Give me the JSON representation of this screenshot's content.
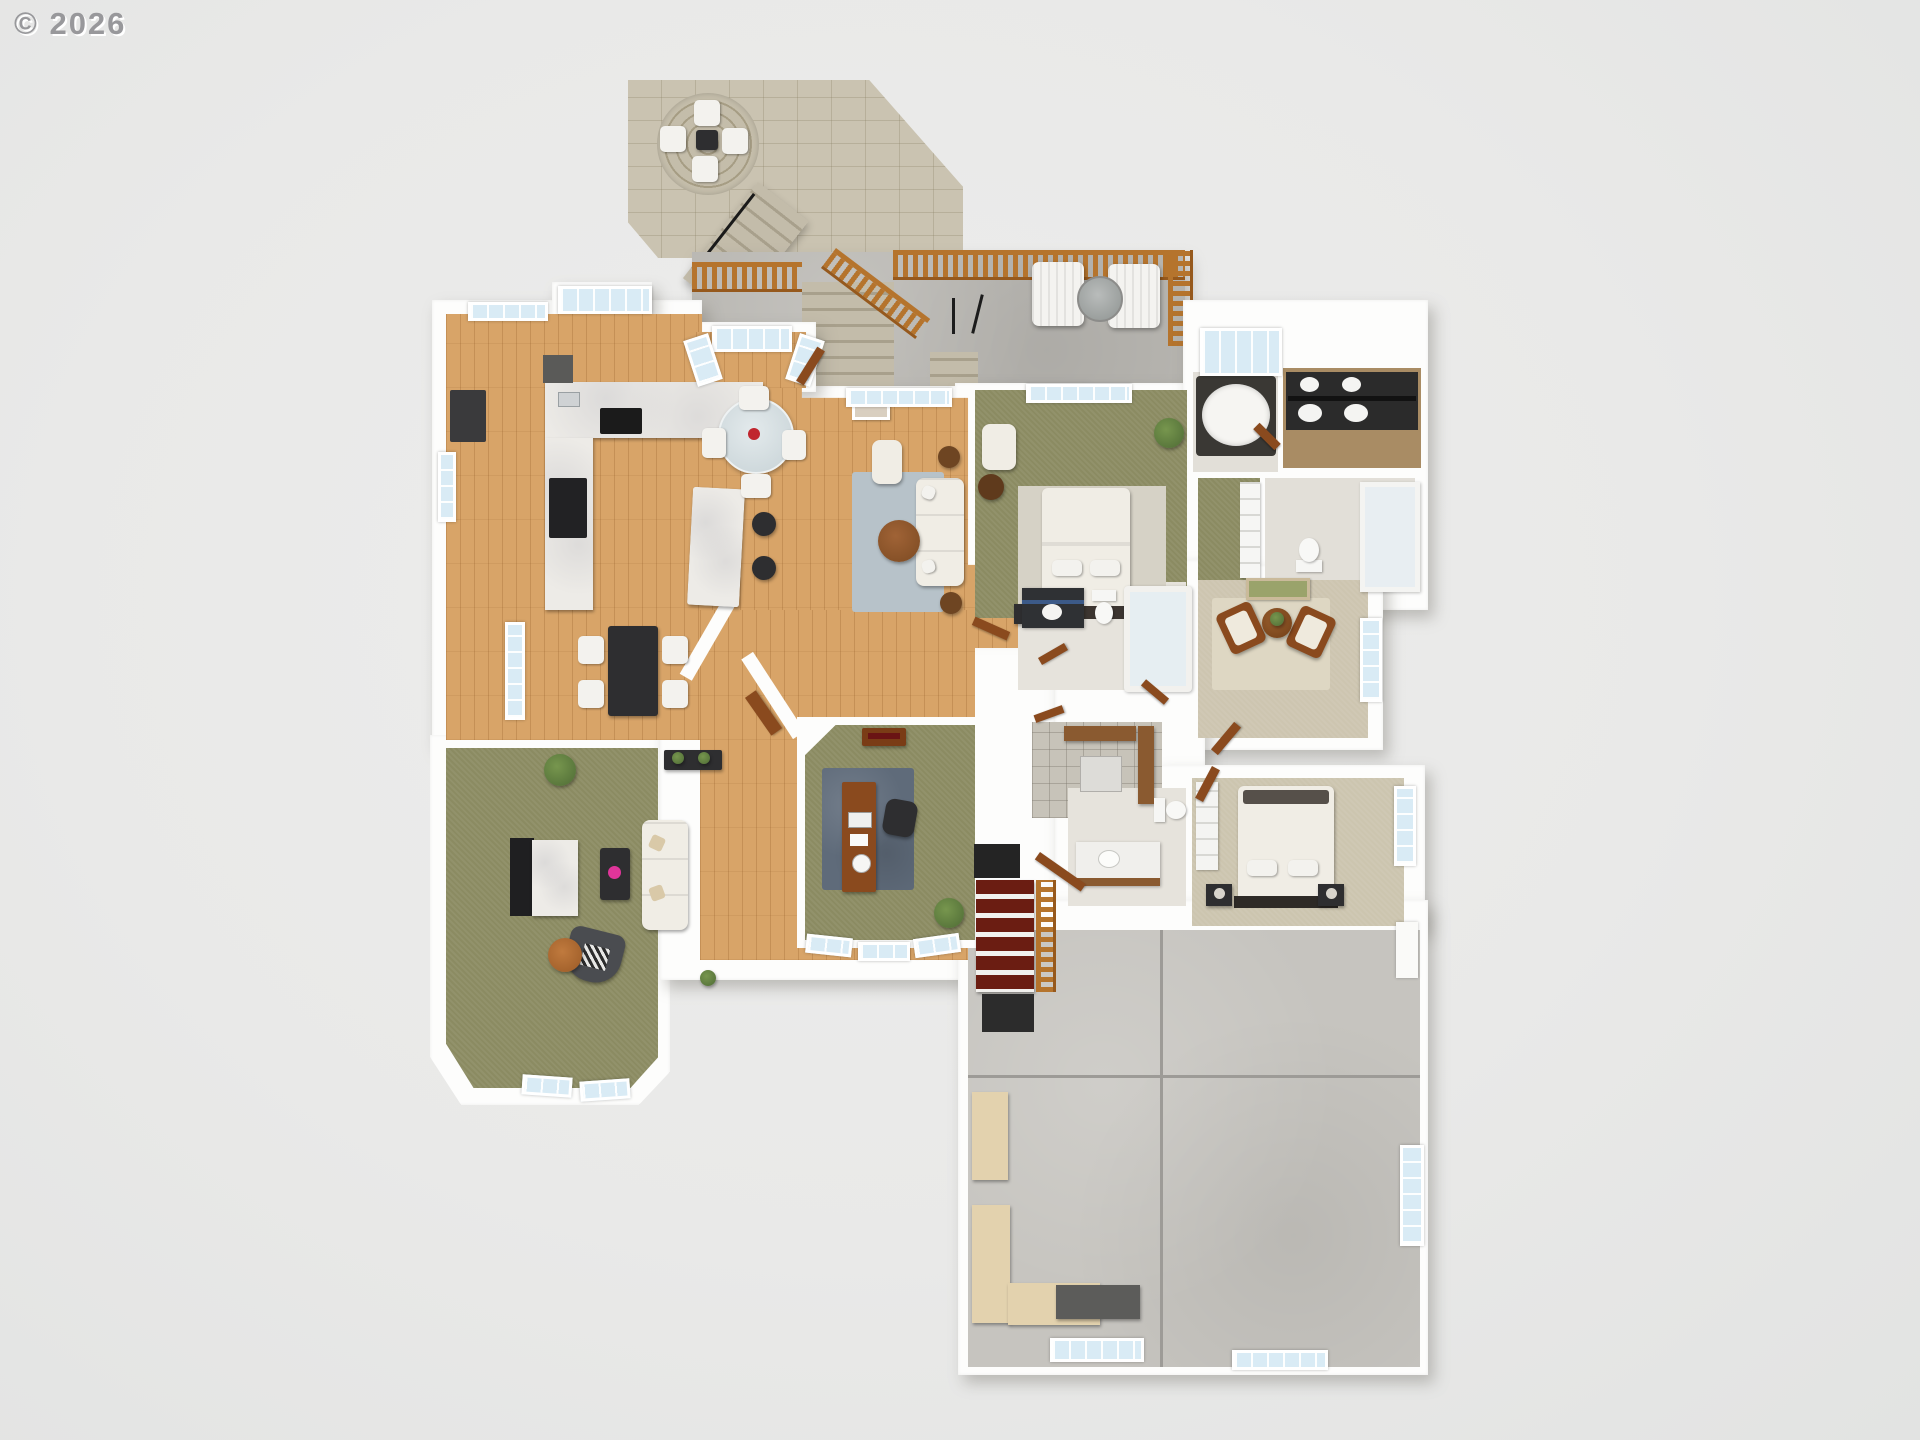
{
  "watermark": {
    "text": "© 2026"
  },
  "image": {
    "kind": "3d-floor-plan-render",
    "view": "top-down-dollhouse",
    "width_px": 1920,
    "height_px": 1440
  },
  "palette": {
    "background": "#e9e9e8",
    "walls": "#fdfdfc",
    "hardwood": "#d8a468",
    "carpet_green": "#8b8b62",
    "carpet_beige": "#ccc5af",
    "carpet_cream": "#cdc5b0",
    "rug_blue_gray": "#b7c2c9",
    "rug_office": "#5f6b7a",
    "deck_concrete": "#b8b6b1",
    "garage_concrete": "#c6c4bf",
    "patio_stone": "#cac3b1",
    "railing_wood": "#b5742d",
    "stair_mahogany": "#6b1d12",
    "marble": "#edebe7",
    "window_glass": "#d9ebf5",
    "dark_furniture": "#2e2e30",
    "wood_furniture": "#8a4a1e",
    "sofa_cream": "#f0ede5",
    "accent_pink": "#e0359a",
    "plant_green": "#4e6b35",
    "tile_grout": "#b5b1a7"
  },
  "regions": [
    {
      "name": "stone-patio"
    },
    {
      "name": "patio-stairs"
    },
    {
      "name": "wood-deck"
    },
    {
      "name": "kitchen"
    },
    {
      "name": "breakfast-nook"
    },
    {
      "name": "dining-room"
    },
    {
      "name": "living-room"
    },
    {
      "name": "family-room"
    },
    {
      "name": "home-office"
    },
    {
      "name": "foyer"
    },
    {
      "name": "master-bedroom"
    },
    {
      "name": "master-bathroom"
    },
    {
      "name": "walk-in-closet"
    },
    {
      "name": "water-closet"
    },
    {
      "name": "sitting-room"
    },
    {
      "name": "hall-bathroom"
    },
    {
      "name": "laundry-mudroom"
    },
    {
      "name": "second-bathroom"
    },
    {
      "name": "second-bedroom"
    },
    {
      "name": "basement-stairs"
    },
    {
      "name": "garage"
    }
  ]
}
